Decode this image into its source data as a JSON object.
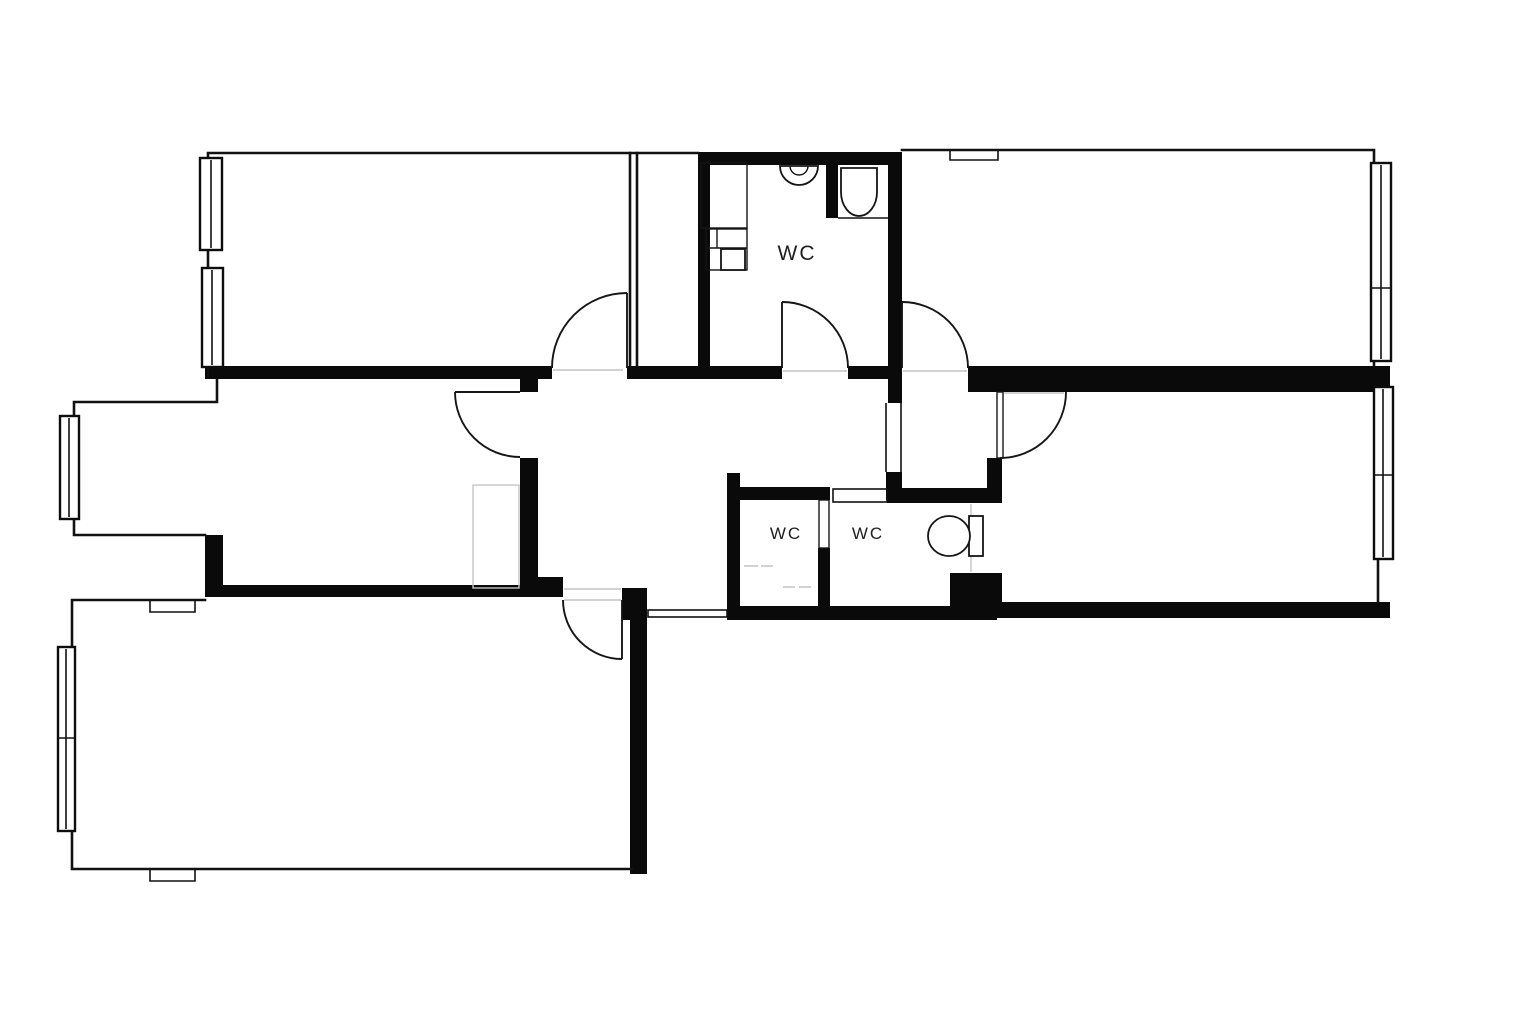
{
  "plan": {
    "type": "apartment-floor-plan",
    "colors": {
      "background": "#ffffff",
      "walls": "#0a0a0a",
      "thin_lines": "#111111",
      "faint_lines": "#c4c4c4",
      "label_text": "#1f1f1f"
    },
    "labels": {
      "bathroom_wc": "WC",
      "small_wc_left": "WC",
      "small_wc_right": "WC"
    },
    "counts": {
      "wc_labels": 3,
      "windows": 6,
      "door_swings": 6
    },
    "icons": {
      "toilet": "toilet-icon",
      "sink": "sink-icon",
      "washing_machine": "washing-machine-icon",
      "wardrobe": "wardrobe-icon",
      "window": "window-icon",
      "door_swing": "door-swing-icon"
    }
  }
}
